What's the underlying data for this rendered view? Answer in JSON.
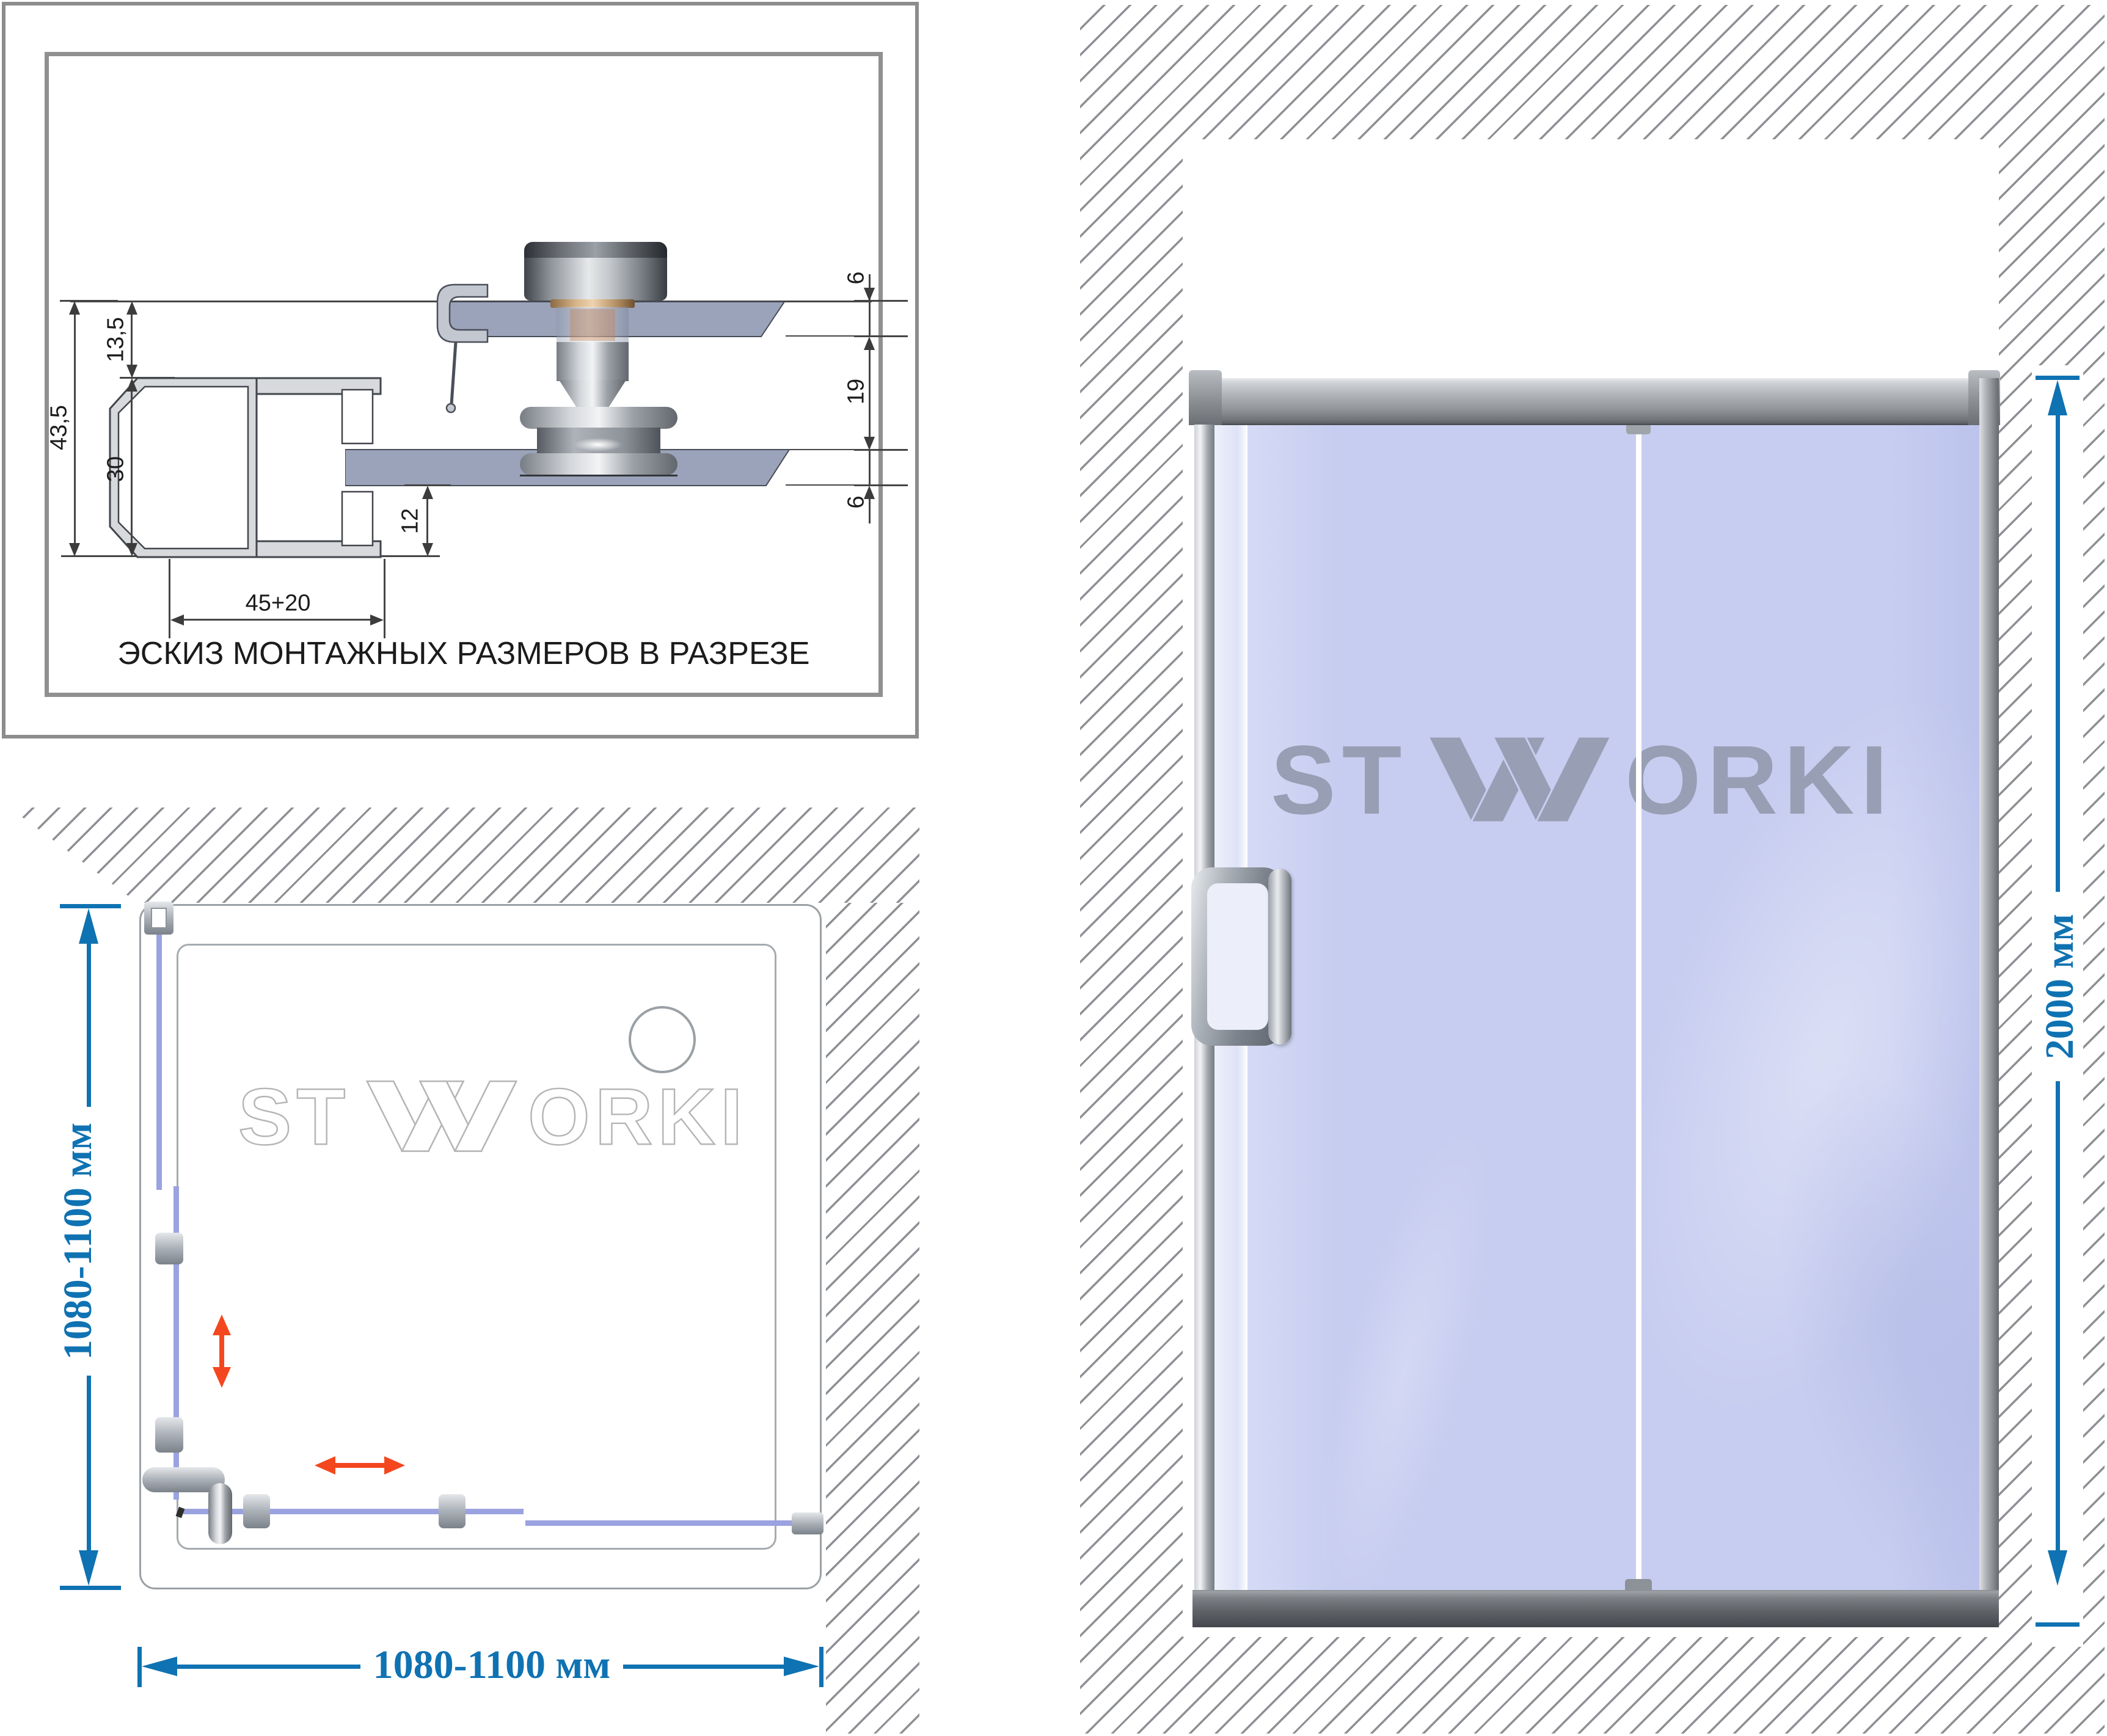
{
  "cross_section": {
    "caption": "ЭСКИЗ МОНТАЖНЫХ РАЗМЕРОВ В РАЗРЕЗЕ",
    "dim_overall_height": "43,5",
    "dim_top_offset": "13,5",
    "dim_profile_height": "30",
    "dim_bottom_inset": "12",
    "dim_profile_width": "45+20",
    "dim_glass_top": "6",
    "dim_roller_gap": "19",
    "dim_glass_bottom": "6"
  },
  "plan_view": {
    "watermark": {
      "left": "ST",
      "right": "ORKI"
    },
    "dim_depth": "1080-1100 мм",
    "dim_width": "1080-1100 мм"
  },
  "door_view": {
    "logo": {
      "left": "ST",
      "right": "ORKI"
    },
    "dim_height": "2000 мм"
  },
  "colors": {
    "dimension_blue": "#0f72b2",
    "arrow_red": "#f4471f",
    "glass_blue": "#c7cdf0",
    "glass_line_purple": "#9ba2e0",
    "hatch_gray": "#8d9296",
    "frame_gray": "#8c8c8c"
  }
}
